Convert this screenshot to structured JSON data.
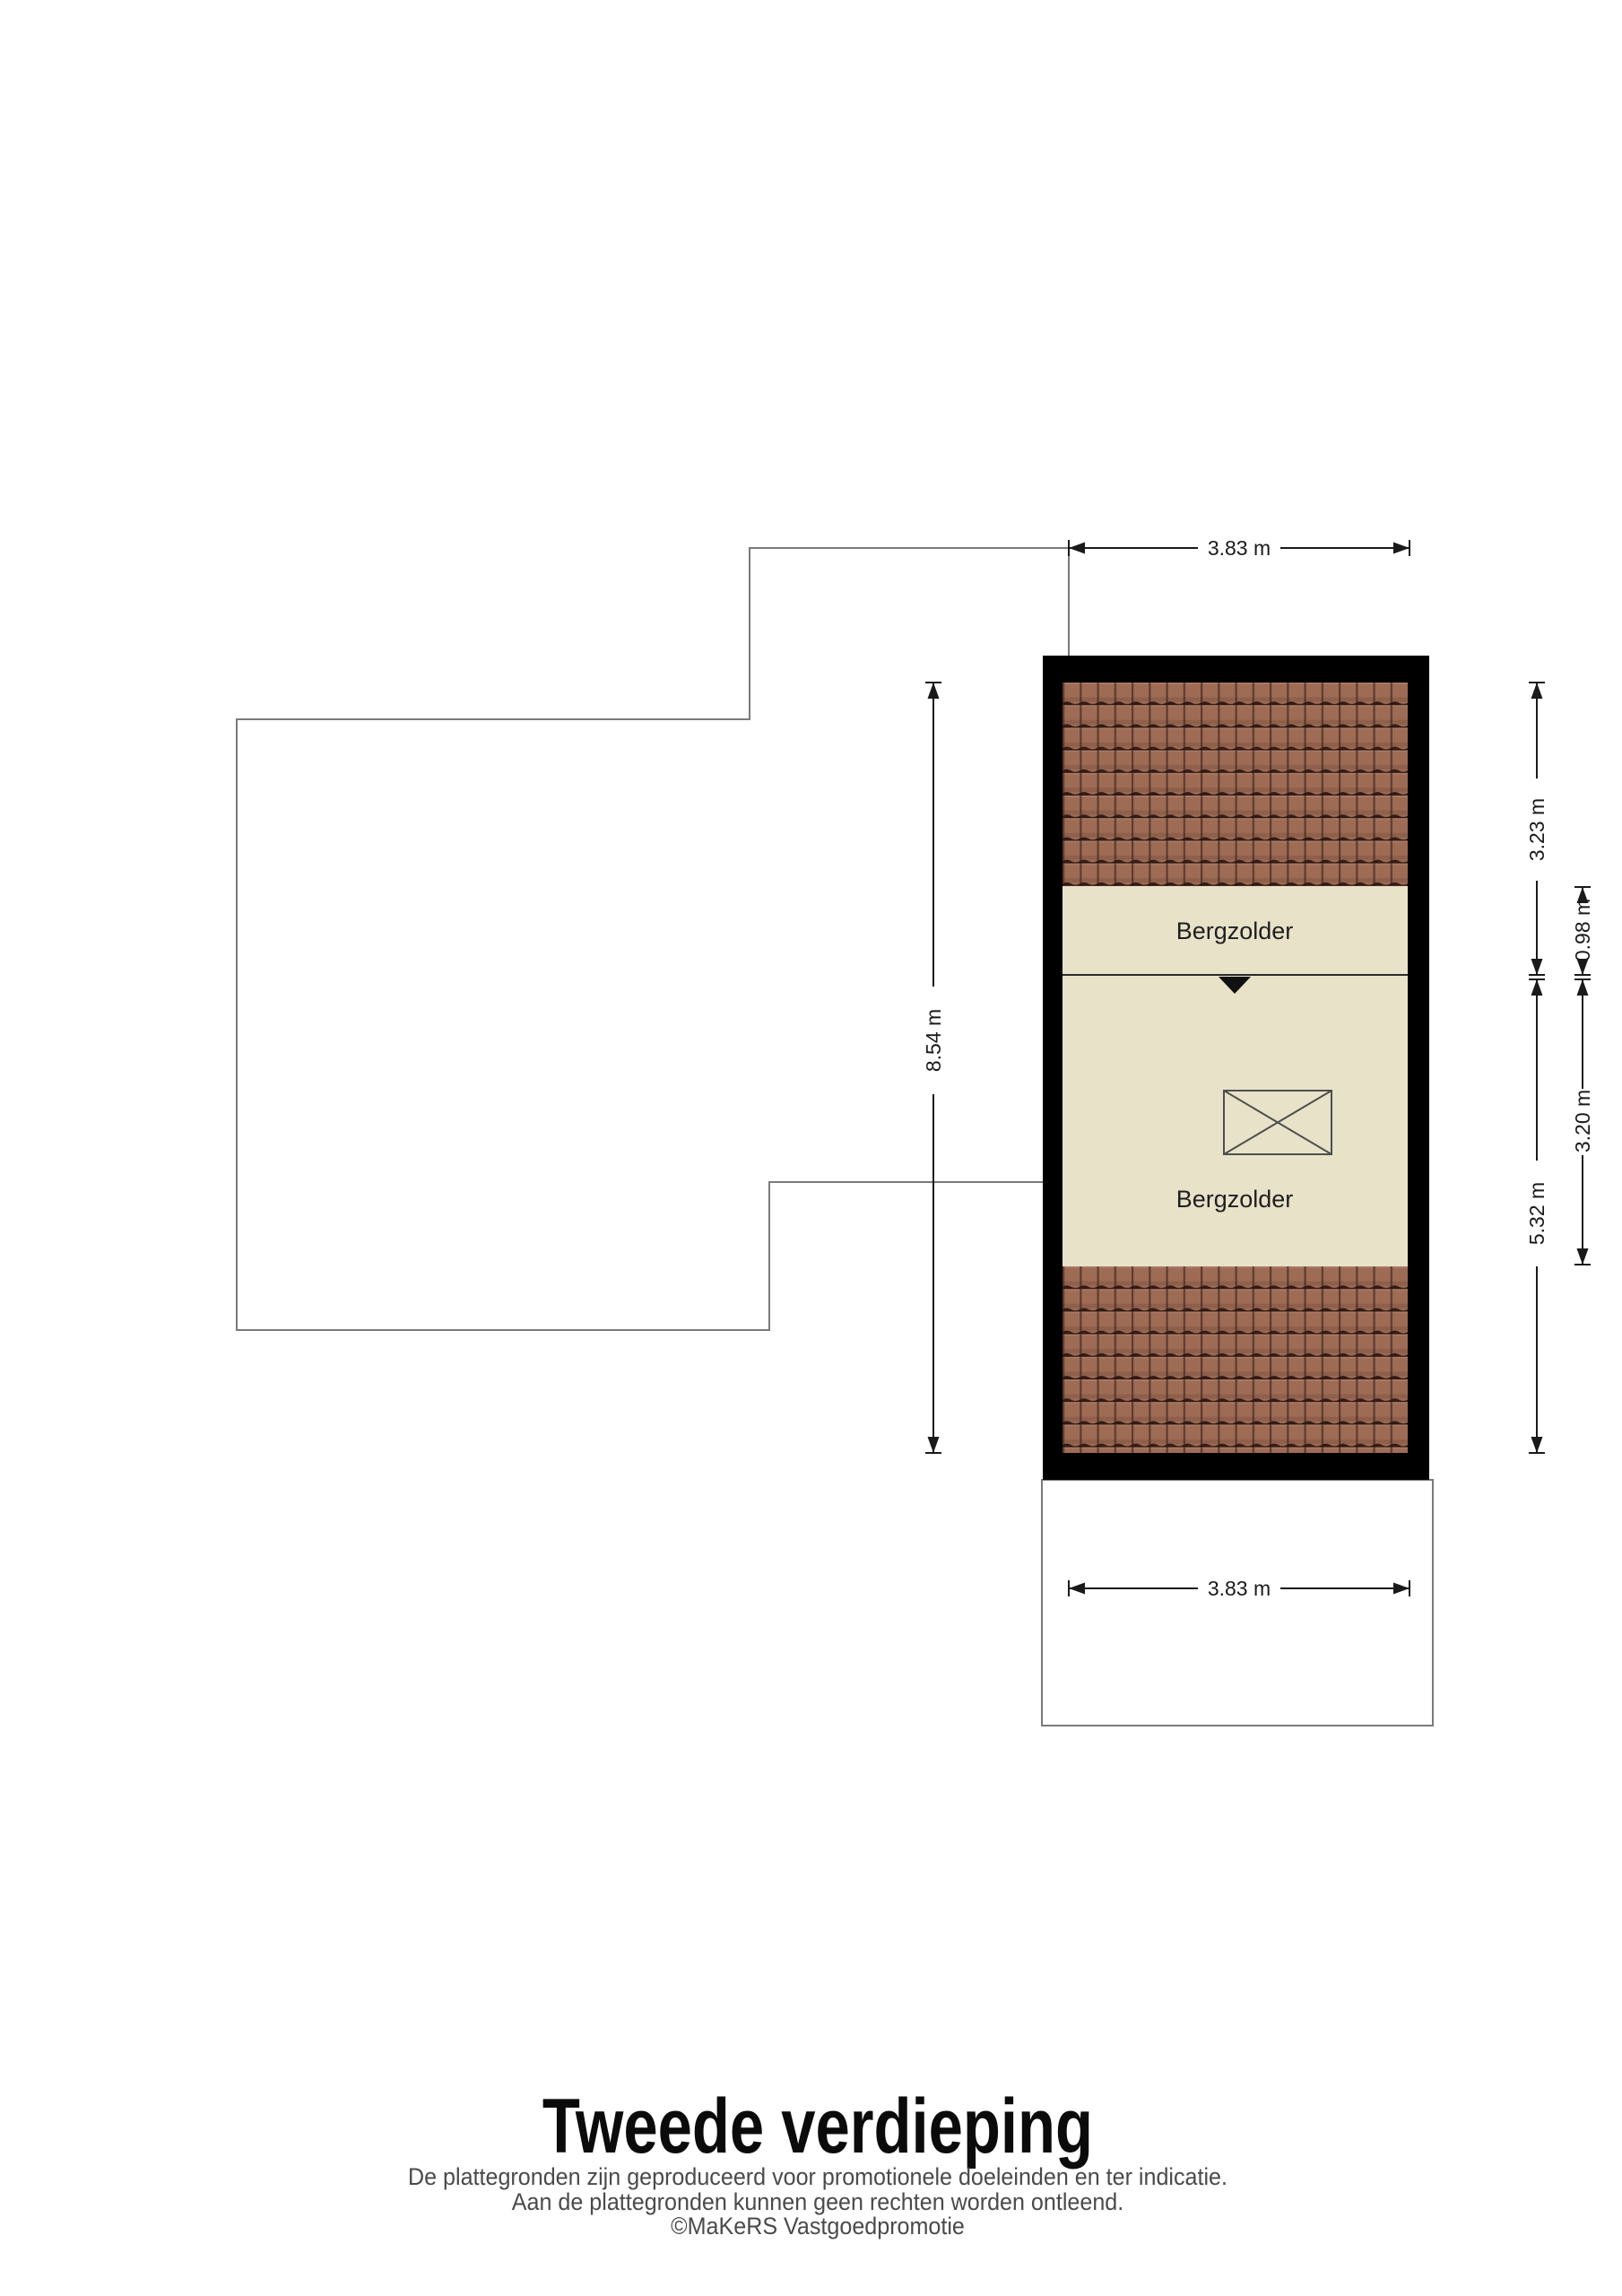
{
  "page": {
    "title": "Tweede verdieping",
    "disclaimer1": "De plattegronden zijn geproduceerd voor promotionele doeleinden en ter indicatie.",
    "disclaimer2": "Aan de plattegronden kunnen geen rechten worden ontleend.",
    "credit": "©MaKeRS Vastgoedpromotie"
  },
  "floorplan": {
    "floor_name": "Tweede verdieping",
    "rooms": [
      {
        "label": "Bergzolder"
      },
      {
        "label": "Bergzolder"
      }
    ],
    "dimensions": {
      "top_width": "3.83 m",
      "bottom_width": "3.83 m",
      "left_height": "8.54 m",
      "right_upper_total": "3.23 m",
      "right_upper_room": "0.98 m",
      "right_lower_total": "5.32 m",
      "right_lower_room": "3.20 m"
    },
    "colors": {
      "wall": "#000000",
      "room_fill": "#e8e2c9",
      "tile_base": "#9e6b55",
      "tile_shadow": "#2a150e",
      "reference_outline": "#7a7a7a",
      "dimension_ink": "#1a1a1a"
    }
  }
}
